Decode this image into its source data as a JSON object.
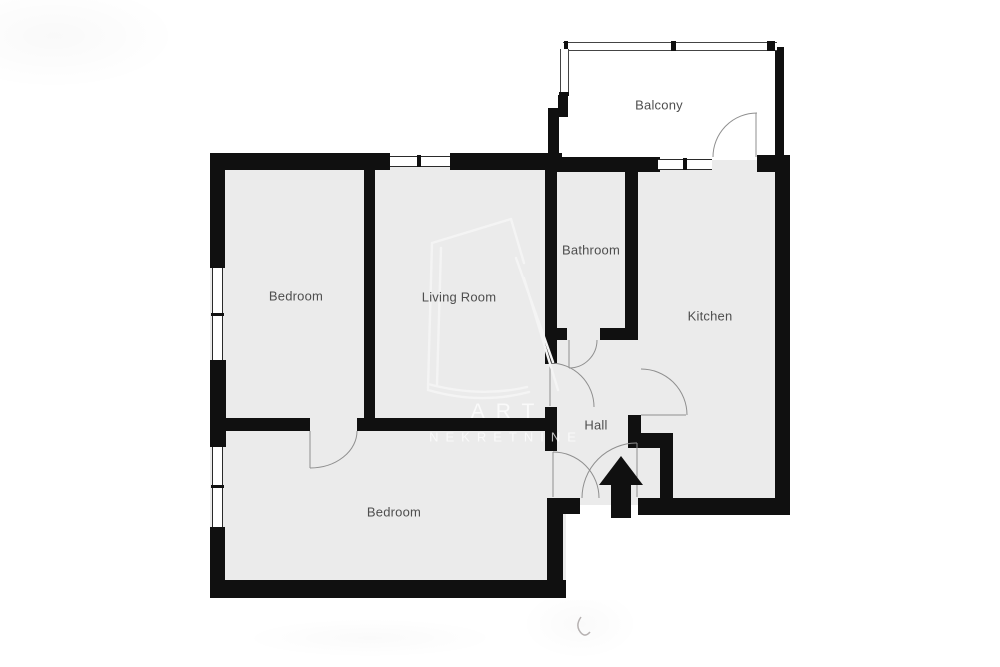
{
  "floorplan": {
    "rooms": {
      "bedroom_top": "Bedroom",
      "living_room": "Living Room",
      "bathroom": "Bathroom",
      "kitchen": "Kitchen",
      "hall": "Hall",
      "bedroom_bottom": "Bedroom",
      "balcony": "Balcony"
    },
    "watermark": {
      "line1": "ART",
      "line2": "NEKRETNINE"
    },
    "icons": {
      "entrance": "entrance-arrow-icon"
    },
    "colors": {
      "wall": "#101010",
      "floor": "#ebebeb",
      "door_swing_line": "#999999",
      "label_text": "#4e4e4e",
      "watermark": "#f4f4f4",
      "background": "#ffffff"
    }
  }
}
